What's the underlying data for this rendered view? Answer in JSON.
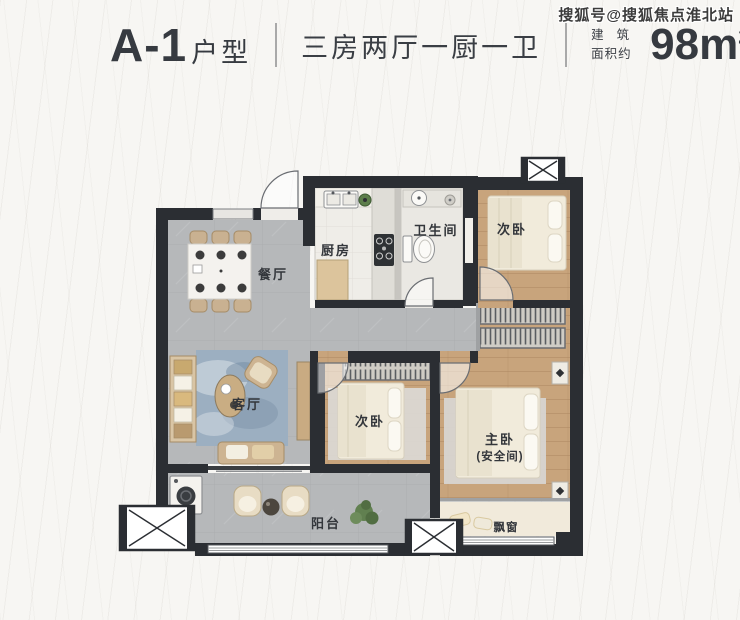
{
  "header": {
    "unit": "A-1",
    "unit_type_label": "户型",
    "layout_description": "三房两厅一厨一卫",
    "area_prefix_top": "建筑",
    "area_prefix_bottom": "面积约",
    "area_number": "98m",
    "area_sup": "2"
  },
  "watermark": {
    "text": "搜狐号@搜狐焦点淮北站"
  },
  "floor_plan": {
    "rooms": [
      {
        "id": "dining",
        "label": "餐厅"
      },
      {
        "id": "living",
        "label": "客厅"
      },
      {
        "id": "kitchen",
        "label": "厨房"
      },
      {
        "id": "bathroom",
        "label": "卫生间"
      },
      {
        "id": "bedroom_top_right",
        "label": "次卧"
      },
      {
        "id": "bedroom_middle",
        "label": "次卧"
      },
      {
        "id": "master_bedroom",
        "label": "主卧"
      },
      {
        "id": "master_bedroom_sub",
        "label": "(安全间)"
      },
      {
        "id": "balcony",
        "label": "阳台"
      },
      {
        "id": "bay_window",
        "label": "飘窗"
      }
    ],
    "colors": {
      "wall": "#2b2e33",
      "tile_floor": "#b6b8ba",
      "wood_floor": "#c8a47c",
      "light_floor": "#efede8",
      "rug_blue": "#9cafc1",
      "rug_gray": "#d9d7d3",
      "furniture_cream": "#f1ebdb",
      "furniture_tan": "#cdb492",
      "plant_green": "#5d7e4b"
    }
  }
}
